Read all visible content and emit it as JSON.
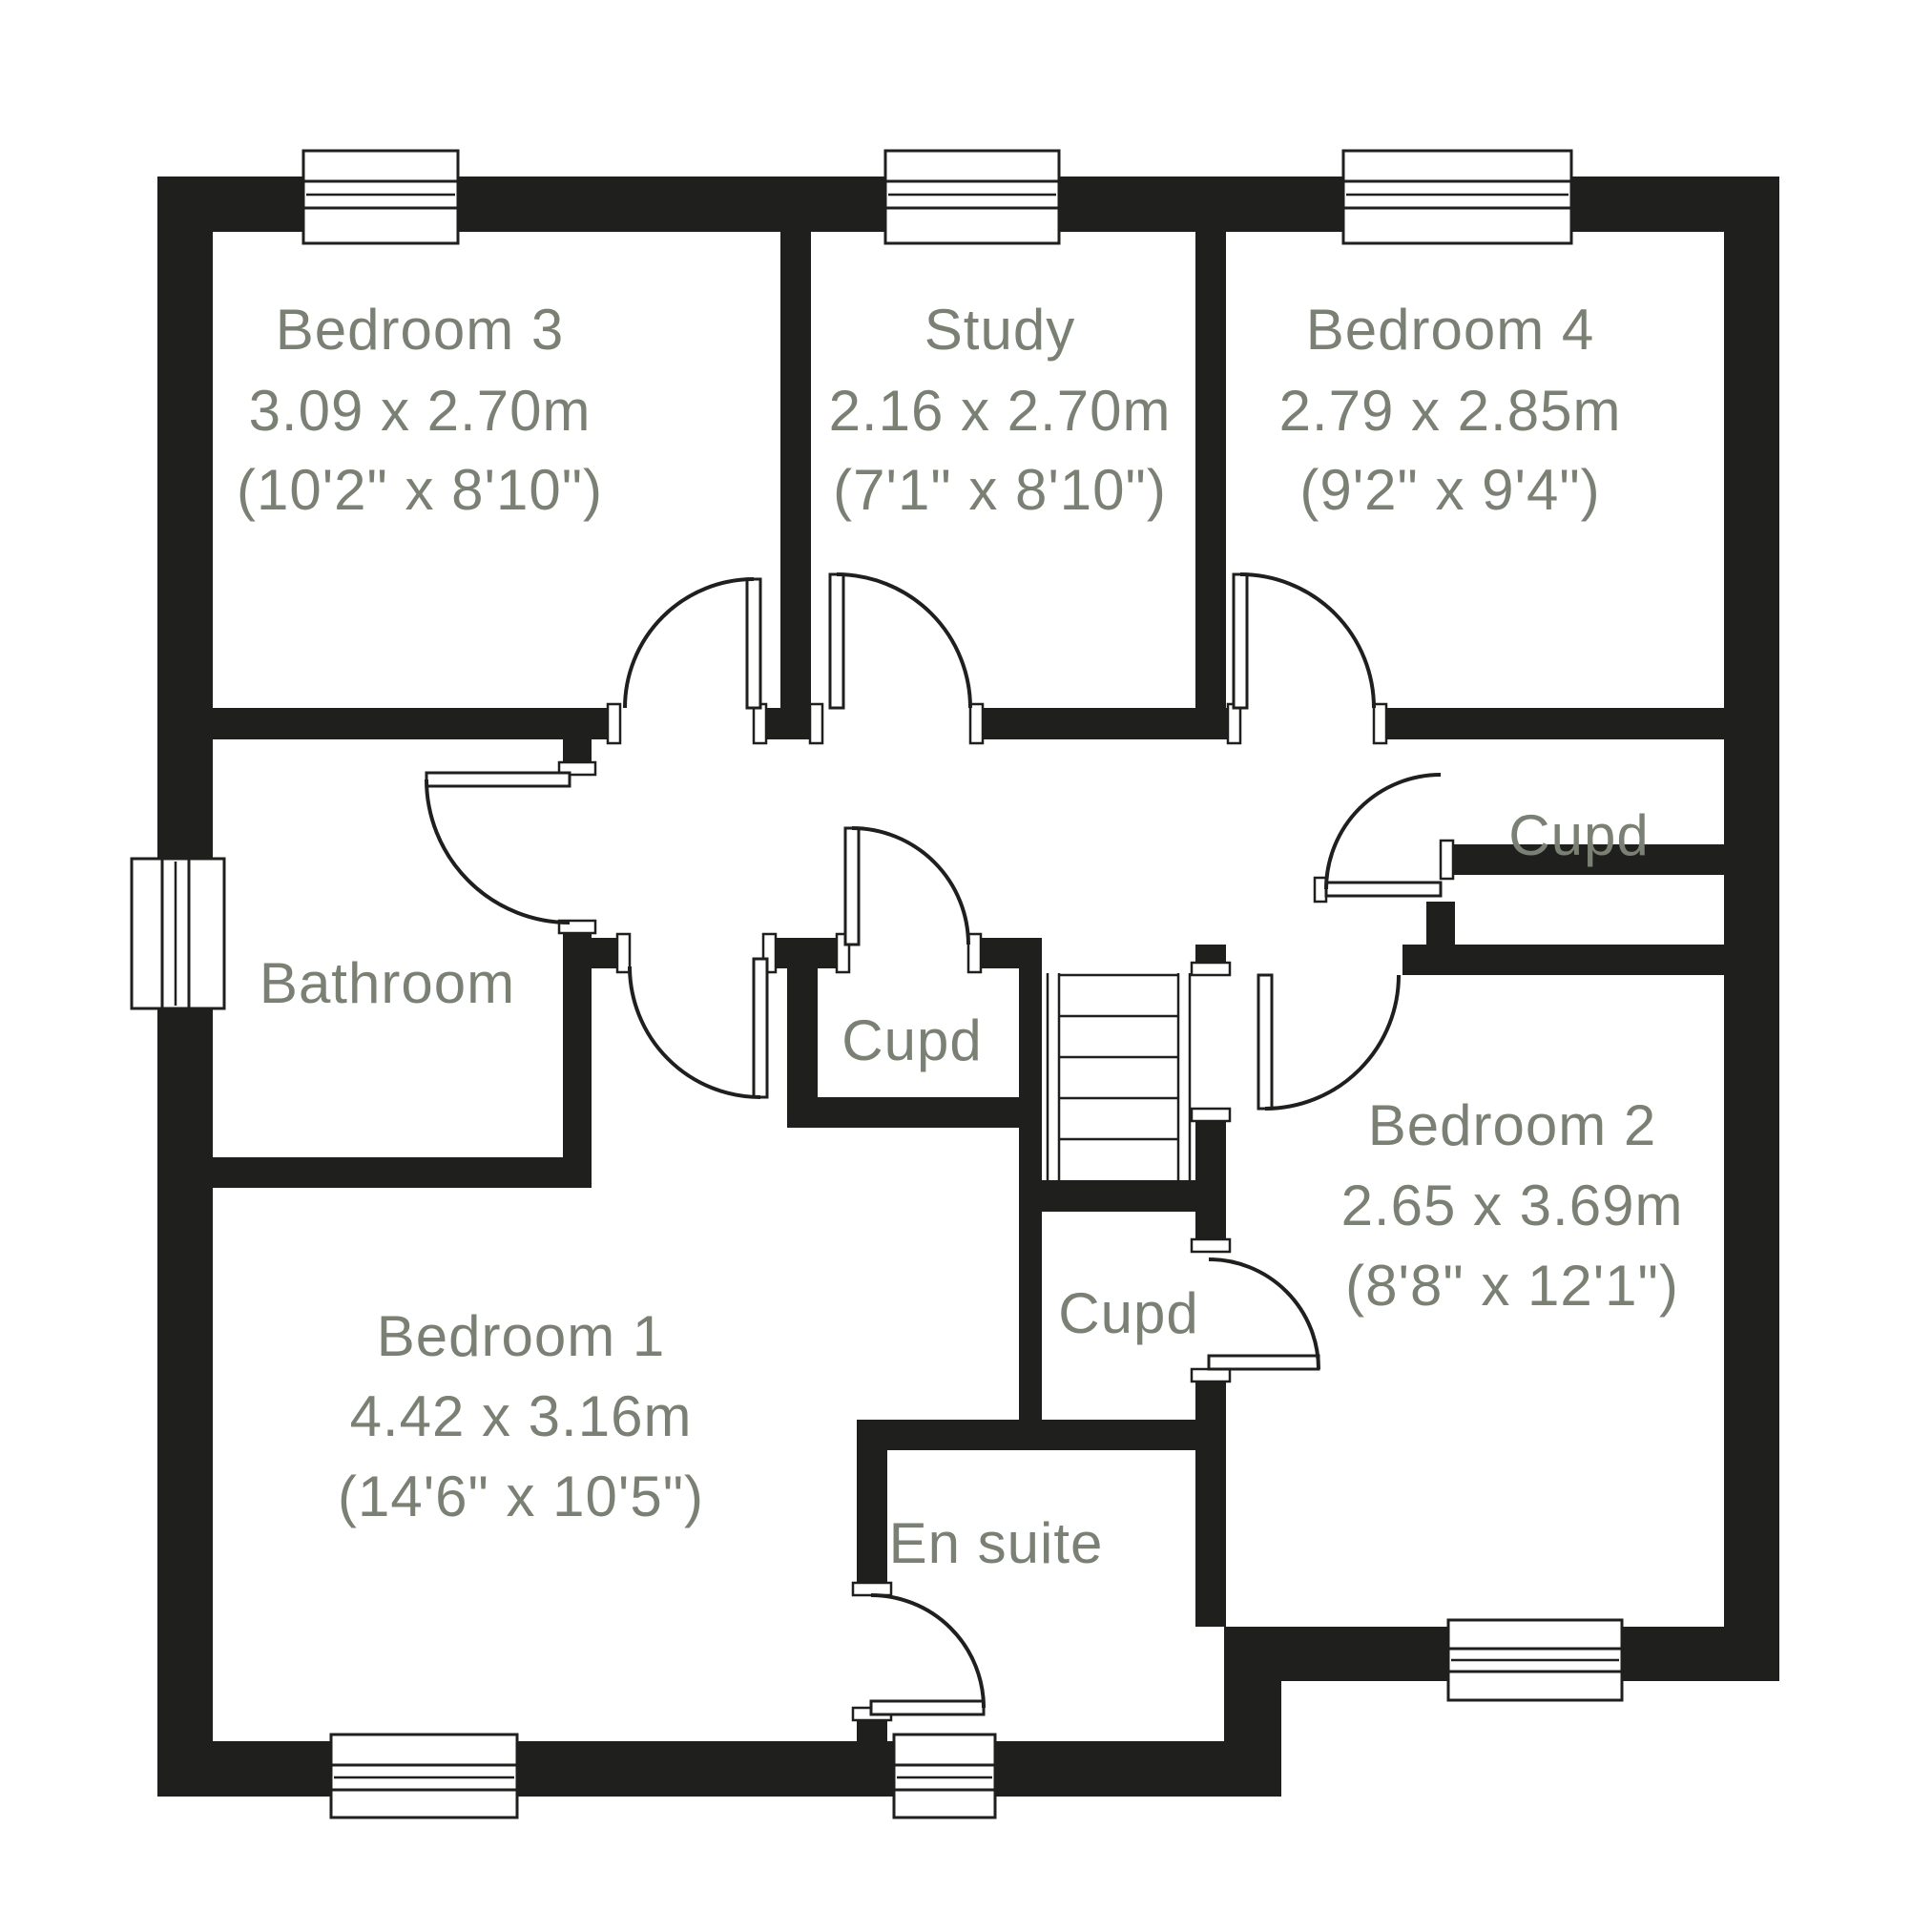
{
  "colors": {
    "wall": "#1f1f1d",
    "line": "#1f1f1d",
    "label": "#7b8074",
    "background": "#ffffff"
  },
  "icons": {
    "door": "quarter-arc-swing",
    "window": "glazing-bar-in-wall",
    "stairs": "treads-with-handrails"
  },
  "rooms": {
    "bedroom3": {
      "name": "Bedroom 3",
      "metric": "3.09 x 2.70m",
      "imperial": "(10'2\" x 8'10\")"
    },
    "study": {
      "name": "Study",
      "metric": "2.16 x 2.70m",
      "imperial": "(7'1\" x 8'10\")"
    },
    "bedroom4": {
      "name": "Bedroom 4",
      "metric": "2.79 x 2.85m",
      "imperial": "(9'2\" x 9'4\")"
    },
    "bathroom": {
      "name": "Bathroom"
    },
    "cupboard_right": {
      "name": "Cupd"
    },
    "cupboard_landing": {
      "name": "Cupd"
    },
    "cupboard_under_stairs": {
      "name": "Cupd"
    },
    "bedroom2": {
      "name": "Bedroom 2",
      "metric": "2.65 x 3.69m",
      "imperial": "(8'8\" x 12'1\")"
    },
    "bedroom1": {
      "name": "Bedroom 1",
      "metric": "4.42 x 3.16m",
      "imperial": "(14'6\" x 10'5\")"
    },
    "ensuite": {
      "name": "En suite"
    }
  }
}
